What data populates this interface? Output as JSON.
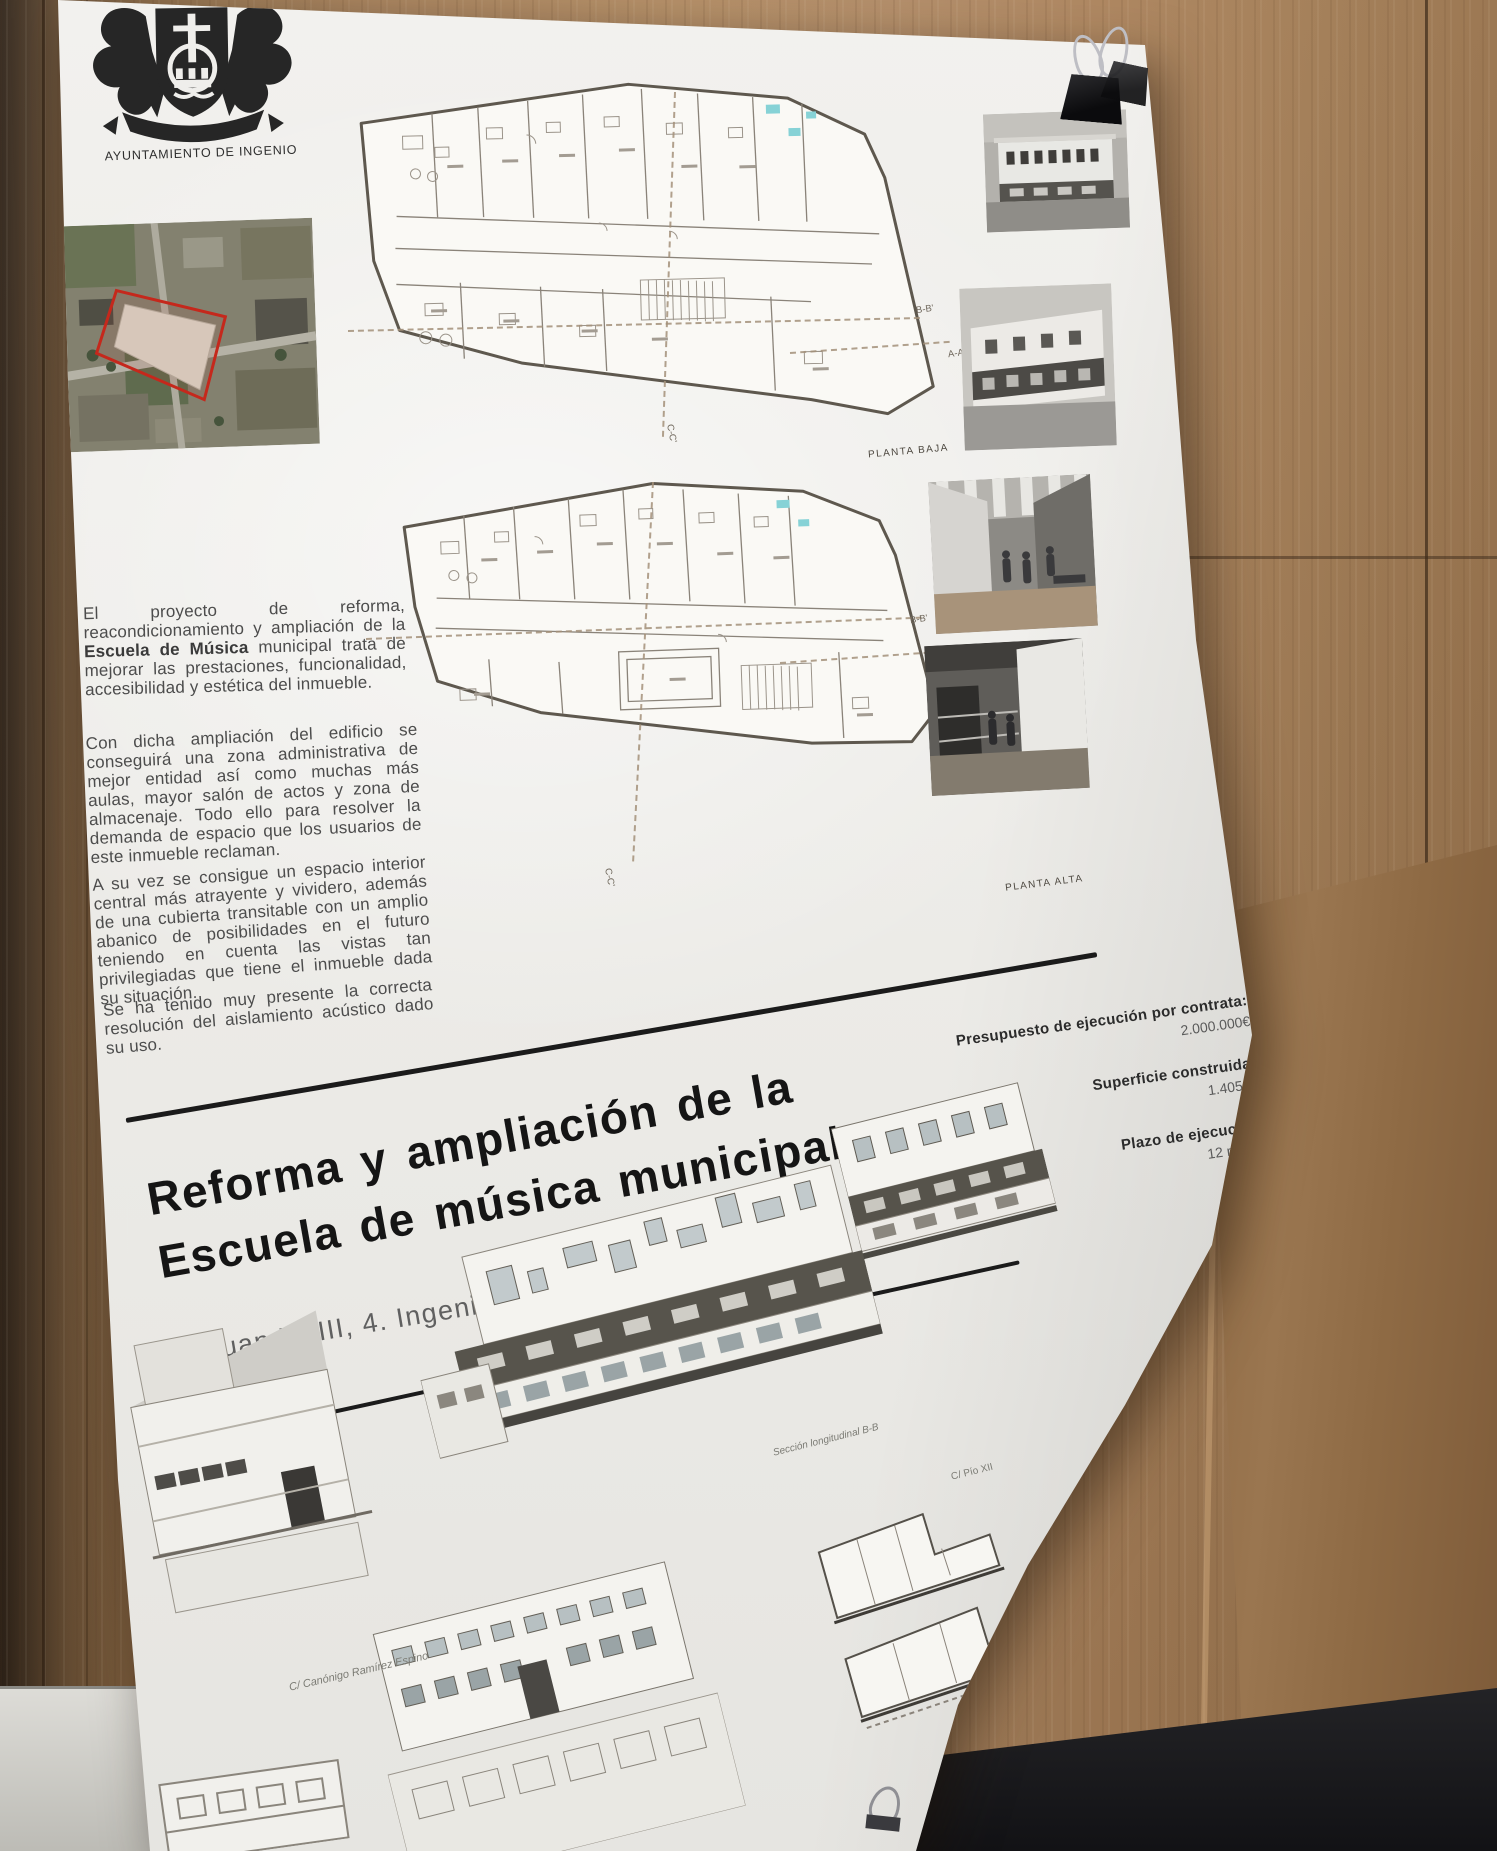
{
  "poster": {
    "org": "AYUNTAMIENTO DE INGENIO",
    "intro": {
      "p1_pre": "El proyecto de reforma, reacondicionamiento y ampliación de la ",
      "p1_bold": "Escuela de Música",
      "p1_post": " municipal trata de mejorar las prestaciones, funcionalidad, accesibilidad y estética del inmueble.",
      "p2": "Con dicha ampliación del edificio se conseguirá una zona administrativa de mejor entidad así como muchas más aulas, mayor salón de actos y zona de almacenaje. Todo ello para resolver la demanda de espacio que los usuarios de este inmueble reclaman.",
      "p3": "A su vez se consigue un espacio interior central más atrayente y vividero, además de una cubierta transitable con un amplio abanico de posibilidades en el futuro teniendo en cuenta las vistas tan privilegiadas que tiene el inmueble dada su situación.",
      "p4": "Se ha tenido muy presente la correcta resolución del aislamiento acústico dado su uso."
    },
    "title_line1": "Reforma y ampliación de la",
    "title_line2": "Escuela de música municipal",
    "address": "C/ Juan XXIII, 4. Ingenio",
    "stats": [
      {
        "label": "Presupuesto de ejecución por contrata:",
        "value": "2.000.000€"
      },
      {
        "label": "Superficie construida:",
        "value": "1.405m²"
      },
      {
        "label": "Plazo de ejecución:",
        "value": "12 meses"
      }
    ],
    "plans": {
      "ground_label": "PLANTA BAJA",
      "upper_label": "PLANTA ALTA"
    },
    "section_markers": {
      "bb": "B-B'",
      "aa": "A-A'",
      "cc": "C-C'"
    },
    "captions": {
      "street_left": "C/ Canónigo Ramírez Espino",
      "street_right": "C/ Pío XII",
      "section": "Sección longitudinal B-B"
    }
  }
}
